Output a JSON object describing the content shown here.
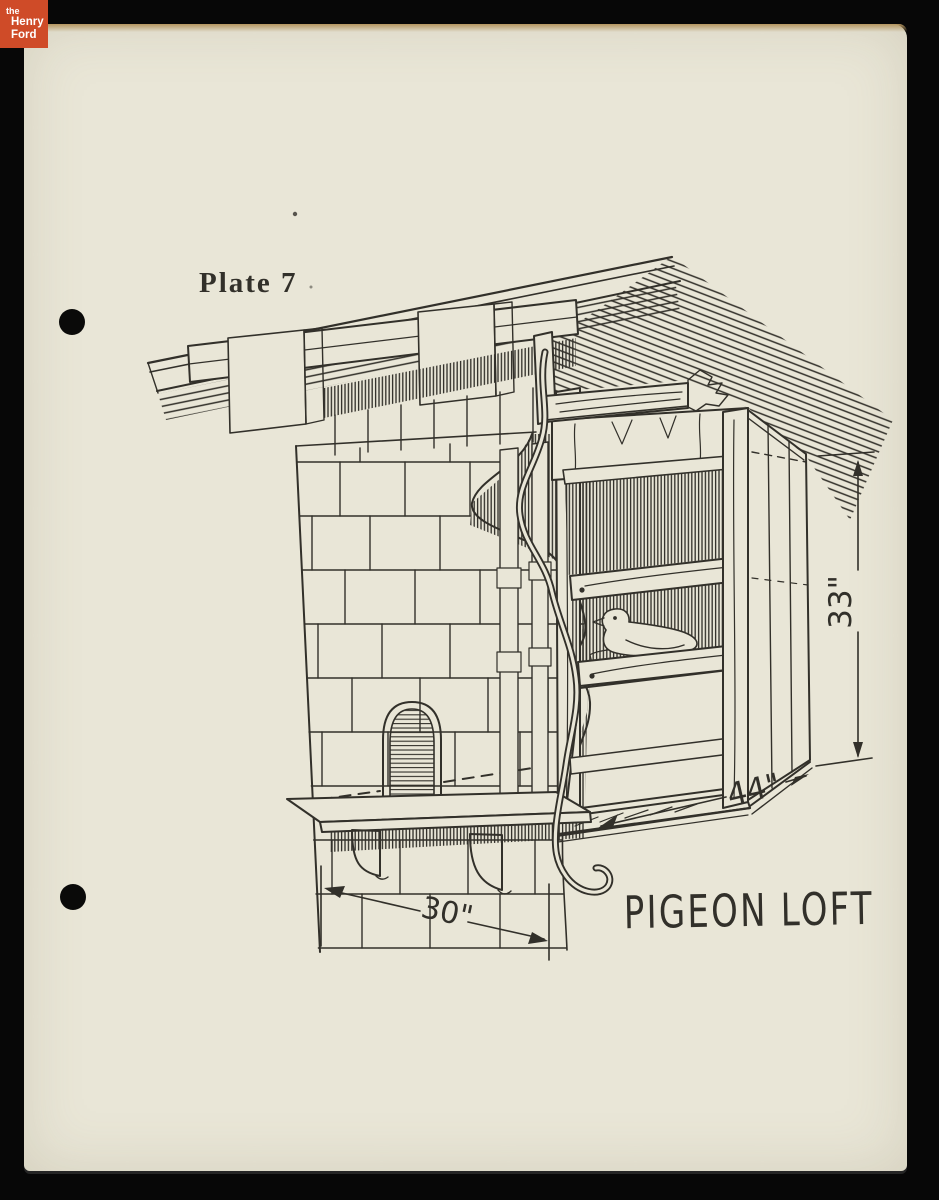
{
  "document": {
    "plate_label": "Plate 7",
    "drawing_title": "PIGEON LOFT",
    "dimension_height": "33\"",
    "dimension_width": "44\"",
    "dimension_chimney_width": "30\""
  },
  "logo": {
    "line1": "the",
    "line2": "Henry",
    "line3": "Ford"
  },
  "colors": {
    "paper": "#e9e6d7",
    "ink": "#32302a",
    "logo_red": "#cf4b28",
    "background": "#070707",
    "edge_tan": "#b4955f"
  }
}
